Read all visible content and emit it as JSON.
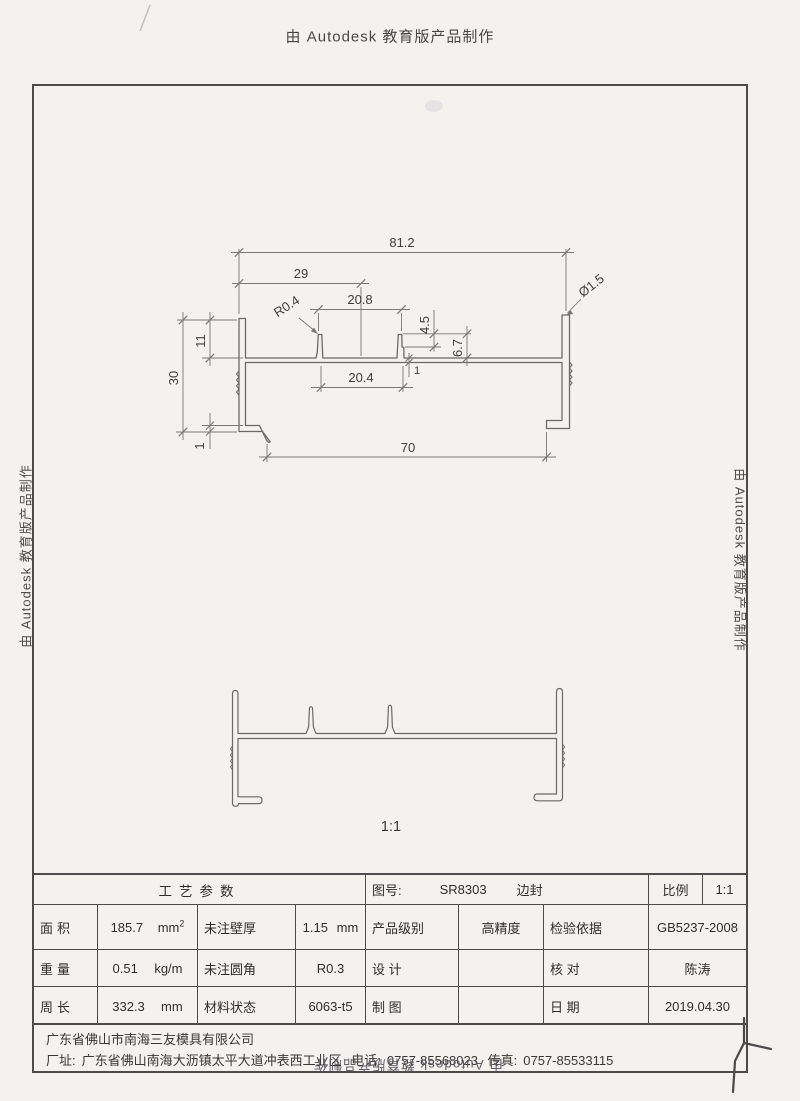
{
  "colors": {
    "paper": "#f4f2ee",
    "line": "#5f5f5f",
    "text": "#303030"
  },
  "page": {
    "watermark_top": "由 Autodesk 教育版产品制作",
    "watermark_left": "由 Autodesk 教育版产品制作",
    "watermark_right": "由 Autodesk 教育版产品制作",
    "watermark_bottom_inverted": "由 Autodesk 教育版产品制作"
  },
  "drawing": {
    "scale_caption": "1:1",
    "dims": {
      "overall_width": "81.2",
      "channel_center_offset": "29",
      "channel_outer_width": "20.8",
      "channel_inner_width": "20.4",
      "corner_radius": "R0.4",
      "rib_step_height": "4.5",
      "rib_height": "6.7",
      "hole_diameter": "Ø1.5",
      "flange_height": "30",
      "upper_flange_height": "11",
      "foot_thickness": "1",
      "web_thickness": "1",
      "bottom_width": "70"
    }
  },
  "title_block": {
    "process_params": "工艺参数",
    "drawing_no_label": "图号:",
    "drawing_no": "SR8303",
    "product_name": "边封",
    "scale_label": "比例",
    "scale_value": "1:1",
    "area_label": "面积",
    "area_value": "185.7",
    "area_unit": "mm",
    "area_unit_sup": "2",
    "wall_label": "未注壁厚",
    "wall_value": "1.15",
    "wall_unit": "mm",
    "grade_label": "产品级别",
    "grade_value": "高精度",
    "inspect_label": "检验依据",
    "inspect_value": "GB5237-2008",
    "weight_label": "重量",
    "weight_value": "0.51",
    "weight_unit": "kg/m",
    "fillet_label": "未注圆角",
    "fillet_value": "R0.3",
    "design_label": "设 计",
    "design_value": "",
    "check_label": "核 对",
    "check_value": "陈涛",
    "perimeter_label": "周长",
    "perimeter_value": "332.3",
    "perimeter_unit": "mm",
    "material_label": "材料状态",
    "material_value": "6063-t5",
    "draft_label": "制 图",
    "draft_value": "",
    "date_label": "日 期",
    "date_value": "2019.04.30"
  },
  "footer": {
    "company": "广东省佛山市南海三友模具有限公司",
    "address_label": "厂址:",
    "address": "广东省佛山南海大沥镇太平大道冲表西工业区",
    "phone_label": "电话:",
    "phone": "0757-85568023",
    "fax_label": "传真:",
    "fax": "0757-85533115"
  }
}
